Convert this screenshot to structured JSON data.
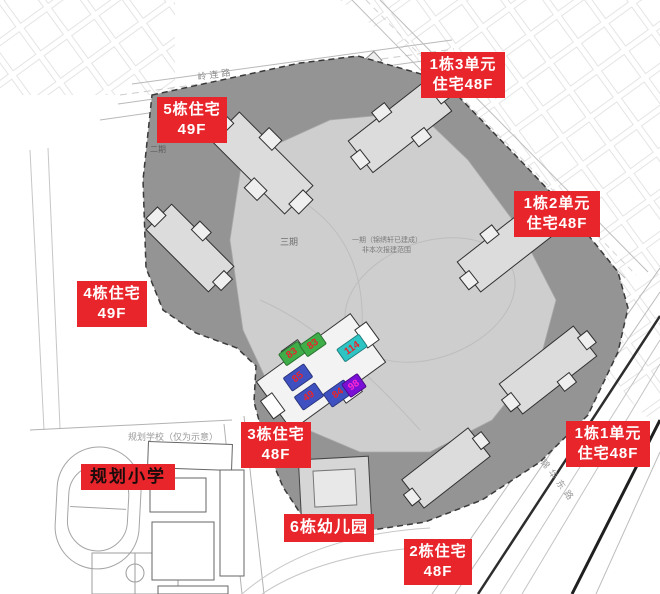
{
  "colors": {
    "label_bg": "#e8252b",
    "label_text": "#ffffff",
    "school_label_text": "#1b0b0b",
    "marker_green": "#3fae49",
    "marker_cyan": "#2ec4c4",
    "marker_blue": "#3f51c1",
    "marker_purple": "#7a0fd6",
    "marker_number": "#e8252b",
    "marker_number_purple": "#ff2bd0",
    "site_fill": "#949494"
  },
  "labels": {
    "b5": {
      "line1": "5栋住宅",
      "line2": "49F"
    },
    "b1u3": {
      "line1": "1栋3单元",
      "line2": "住宅48F"
    },
    "b1u2": {
      "line1": "1栋2单元",
      "line2": "住宅48F"
    },
    "b4": {
      "line1": "4栋住宅",
      "line2": "49F"
    },
    "b3": {
      "line1": "3栋住宅",
      "line2": "48F"
    },
    "school": {
      "line1": "规划小学"
    },
    "kindergarten": {
      "line1": "6栋幼儿园"
    },
    "b1u1": {
      "line1": "1栋1单元",
      "line2": "住宅48F"
    },
    "b2": {
      "line1": "2栋住宅",
      "line2": "48F"
    }
  },
  "roads": {
    "north": "岭连路",
    "southeast": "锦华东路"
  },
  "plan_notes": {
    "school_note": "规划学校（仅为示意）",
    "phase2": "二期",
    "phase3": "三期",
    "phase1_line1": "一期（锦绣轩已建成）",
    "phase1_line2": "非本次报建范围"
  },
  "unit_markers": {
    "g1": "83",
    "g2": "83",
    "c1": "114",
    "bl1": "85",
    "bl2": "49",
    "bl3": "84",
    "p1": "98"
  }
}
